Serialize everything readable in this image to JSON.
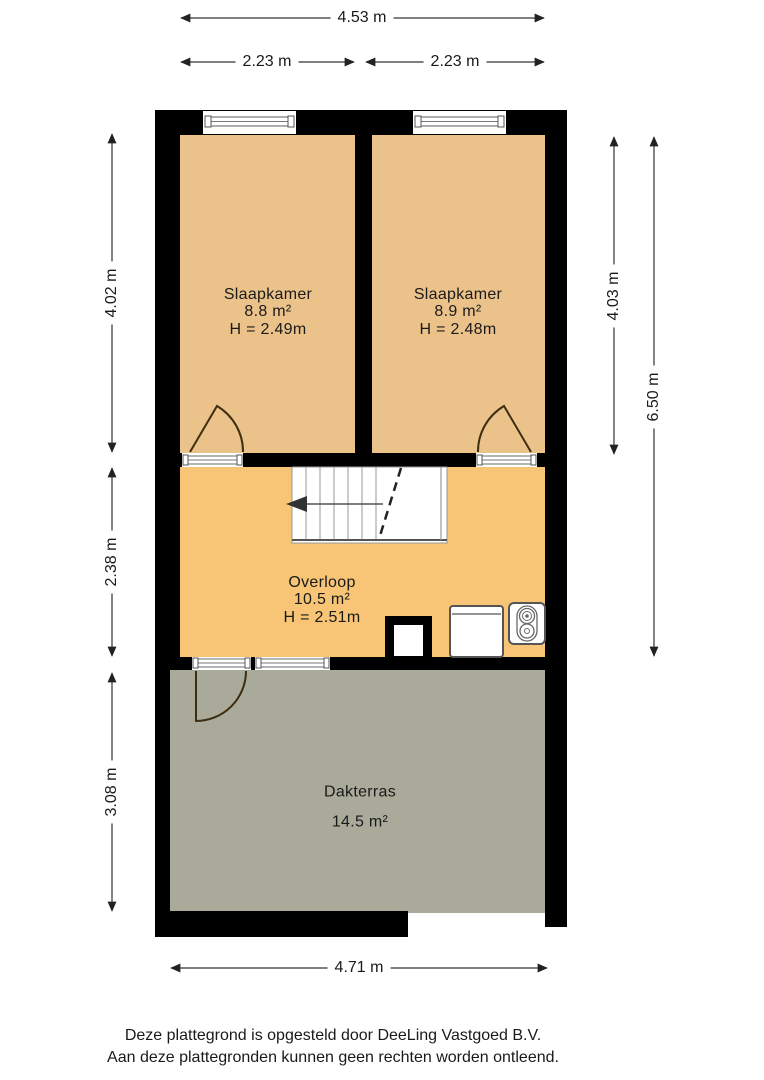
{
  "title": "Floor plan (plattegrond) – verdieping met slaapkamers en dakterras",
  "dimensions": {
    "top_total": "4.53 m",
    "top_left": "2.23 m",
    "top_right": "2.23 m",
    "left_upper": "4.02 m",
    "left_middle": "2.38 m",
    "left_lower": "3.08 m",
    "right_inner": "4.03 m",
    "right_outer": "6.50 m",
    "bottom": "4.71 m"
  },
  "rooms": [
    {
      "name": "Slaapkamer",
      "area": "8.8 m²",
      "height": "H = 2.49m"
    },
    {
      "name": "Slaapkamer",
      "area": "8.9 m²",
      "height": "H = 2.48m"
    },
    {
      "name": "Overloop",
      "area": "10.5 m²",
      "height": "H = 2.51m"
    },
    {
      "name": "Dakterras",
      "area": "14.5 m²"
    }
  ],
  "footer": {
    "line1": "Deze plattegrond is opgesteld door DeeLing Vastgoed B.V.",
    "line2": "Aan deze plattegronden kunnen geen rechten worden ontleend."
  },
  "icons": {
    "stair_direction_arrow": "left-pointing solid triangle",
    "door_swing": "quarter-circle arc",
    "window": "double-line glazing symbol",
    "washing_machine": "rounded square appliance",
    "ventilation_unit": "box with two concentric circles"
  },
  "colors": {
    "wall": "#000000",
    "bedroom": "#ecc28b",
    "landing": "#f8c475",
    "terrace": "#a9aa99",
    "door": "#3d2e0f",
    "text": "#1a1a1a",
    "dimline": "#333333"
  }
}
